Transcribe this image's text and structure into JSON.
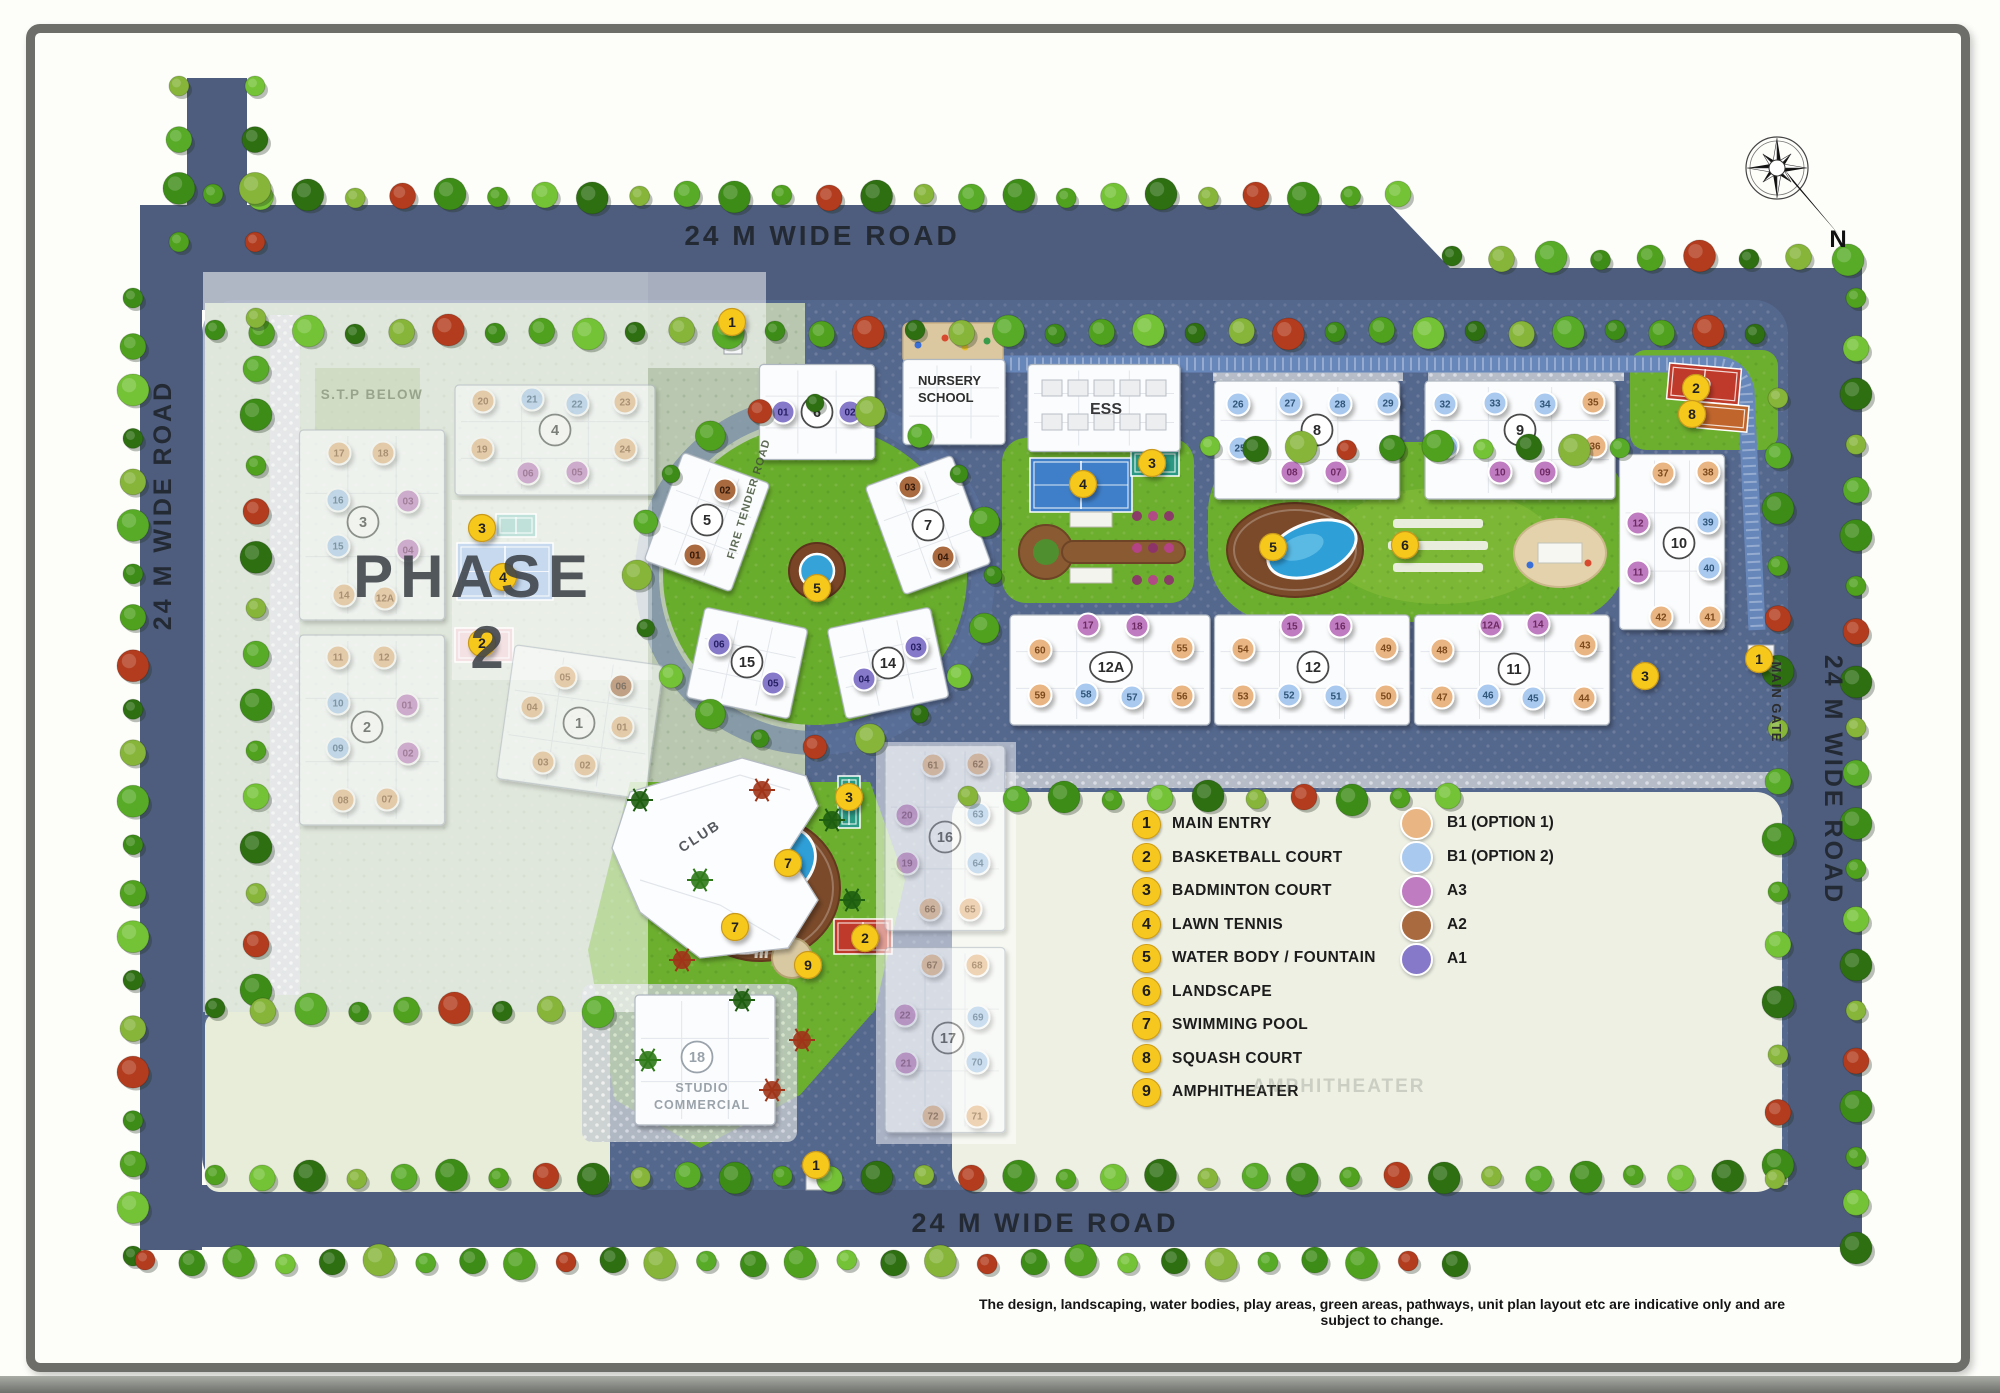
{
  "labels": {
    "road_top": "24 M WIDE ROAD",
    "road_bottom": "24 M WIDE ROAD",
    "road_left": "24 M WIDE ROAD",
    "road_right": "24 M WIDE ROAD",
    "main_gate": "MAIN GATE",
    "fire_tender": "FIRE TENDER ROAD",
    "stp": "S.T.P BELOW",
    "phase_line1": "PHASE",
    "phase_line2": "2",
    "compass_n": "N"
  },
  "special": {
    "nursery_line1": "NURSERY",
    "nursery_line2": "SCHOOL",
    "ess": "ESS",
    "club": "CLUB",
    "studio_line1": "STUDIO",
    "studio_line2": "COMMERCIAL"
  },
  "disclaimer": "The design, landscaping, water bodies, play areas, green areas, pathways, unit plan layout etc are indicative only and are subject to change.",
  "legend": {
    "items": [
      {
        "num": "1",
        "label": "MAIN ENTRY"
      },
      {
        "num": "2",
        "label": "BASKETBALL COURT"
      },
      {
        "num": "3",
        "label": "BADMINTON COURT"
      },
      {
        "num": "4",
        "label": "LAWN TENNIS"
      },
      {
        "num": "5",
        "label": "WATER BODY / FOUNTAIN"
      },
      {
        "num": "6",
        "label": "LANDSCAPE"
      },
      {
        "num": "7",
        "label": "SWIMMING POOL"
      },
      {
        "num": "8",
        "label": "SQUASH COURT"
      },
      {
        "num": "9",
        "label": "AMPHITHEATER"
      }
    ],
    "unit_types": [
      {
        "code": "t1",
        "label": "B1 (OPTION 1)",
        "color": "#e8b583"
      },
      {
        "code": "t2",
        "label": "B1 (OPTION 2)",
        "color": "#a9c9ef"
      },
      {
        "code": "a3",
        "label": "A3",
        "color": "#bf7cc0"
      },
      {
        "code": "a2",
        "label": "A2",
        "color": "#a96a3f"
      },
      {
        "code": "a1",
        "label": "A1",
        "color": "#8779c9"
      }
    ],
    "watermark": "AMPHITHEATER"
  },
  "unit_text_colors": {
    "t1": "#7c4a1d",
    "t2": "#2f5578",
    "a3": "#6d2a62",
    "a2": "#33190a",
    "a1": "#241e63"
  },
  "markers": [
    {
      "n": "1",
      "x": 732,
      "y": 322
    },
    {
      "n": "3",
      "x": 482,
      "y": 528
    },
    {
      "n": "4",
      "x": 503,
      "y": 577
    },
    {
      "n": "2",
      "x": 482,
      "y": 643
    },
    {
      "n": "4",
      "x": 1083,
      "y": 484
    },
    {
      "n": "3",
      "x": 1152,
      "y": 463
    },
    {
      "n": "5",
      "x": 817,
      "y": 588
    },
    {
      "n": "5",
      "x": 1273,
      "y": 547
    },
    {
      "n": "6",
      "x": 1405,
      "y": 545
    },
    {
      "n": "2",
      "x": 1696,
      "y": 388
    },
    {
      "n": "8",
      "x": 1692,
      "y": 414
    },
    {
      "n": "3",
      "x": 1645,
      "y": 676
    },
    {
      "n": "1",
      "x": 1759,
      "y": 659
    },
    {
      "n": "3",
      "x": 849,
      "y": 797
    },
    {
      "n": "7",
      "x": 788,
      "y": 863
    },
    {
      "n": "7",
      "x": 735,
      "y": 927
    },
    {
      "n": "2",
      "x": 865,
      "y": 938
    },
    {
      "n": "9",
      "x": 808,
      "y": 965
    },
    {
      "n": "1",
      "x": 816,
      "y": 1165
    }
  ],
  "gates": [
    {
      "x": 724,
      "y": 330,
      "w": 18,
      "h": 24
    },
    {
      "x": 1748,
      "y": 645,
      "w": 26,
      "h": 18
    },
    {
      "x": 806,
      "y": 1168,
      "w": 18,
      "h": 22
    }
  ],
  "buildings": [
    {
      "num": "4",
      "cx": 555,
      "cy": 440,
      "w": 200,
      "h": 110,
      "nx": 555,
      "ny": 430,
      "faded": true,
      "units": [
        [
          "20",
          "t1",
          483,
          401
        ],
        [
          "21",
          "t2",
          532,
          399
        ],
        [
          "22",
          "t2",
          577,
          404
        ],
        [
          "23",
          "t1",
          625,
          402
        ],
        [
          "19",
          "t1",
          482,
          449
        ],
        [
          "24",
          "t1",
          625,
          449
        ],
        [
          "06",
          "a3",
          528,
          473
        ],
        [
          "05",
          "a3",
          577,
          472
        ]
      ]
    },
    {
      "num": "3",
      "cx": 372,
      "cy": 525,
      "w": 145,
      "h": 190,
      "nx": 363,
      "ny": 522,
      "faded": true,
      "units": [
        [
          "17",
          "t1",
          339,
          453
        ],
        [
          "18",
          "t1",
          383,
          453
        ],
        [
          "16",
          "t2",
          338,
          500
        ],
        [
          "03",
          "a3",
          408,
          501
        ],
        [
          "15",
          "t2",
          338,
          546
        ],
        [
          "04",
          "a3",
          408,
          550
        ],
        [
          "14",
          "t1",
          344,
          595
        ],
        [
          "12A",
          "t1",
          385,
          598
        ]
      ]
    },
    {
      "num": "2",
      "cx": 372,
      "cy": 730,
      "w": 145,
      "h": 190,
      "nx": 367,
      "ny": 727,
      "faded": true,
      "units": [
        [
          "11",
          "t1",
          338,
          657
        ],
        [
          "12",
          "t1",
          384,
          657
        ],
        [
          "10",
          "t2",
          338,
          703
        ],
        [
          "01",
          "a3",
          407,
          705
        ],
        [
          "09",
          "t2",
          338,
          748
        ],
        [
          "02",
          "a3",
          408,
          753
        ],
        [
          "08",
          "t1",
          343,
          800
        ],
        [
          "07",
          "t1",
          387,
          799
        ]
      ]
    },
    {
      "num": "1",
      "cx": 580,
      "cy": 722,
      "w": 150,
      "h": 135,
      "nx": 579,
      "ny": 723,
      "rot": 8,
      "faded": true,
      "units": [
        [
          "05",
          "t1",
          565,
          677
        ],
        [
          "06",
          "a2",
          621,
          686
        ],
        [
          "04",
          "t1",
          532,
          707
        ],
        [
          "01",
          "t1",
          622,
          727
        ],
        [
          "03",
          "t1",
          543,
          762
        ],
        [
          "02",
          "t1",
          585,
          765
        ]
      ]
    },
    {
      "num": "6",
      "cx": 817,
      "cy": 412,
      "w": 115,
      "h": 95,
      "nx": 817,
      "ny": 412,
      "units": [
        [
          "01",
          "a1",
          783,
          412
        ],
        [
          "02",
          "a1",
          850,
          412
        ]
      ]
    },
    {
      "num": "5",
      "cx": 707,
      "cy": 522,
      "w": 92,
      "h": 115,
      "nx": 707,
      "ny": 520,
      "rot": 20,
      "units": [
        [
          "02",
          "a2",
          725,
          490
        ],
        [
          "01",
          "a2",
          695,
          555
        ]
      ]
    },
    {
      "num": "7",
      "cx": 928,
      "cy": 525,
      "w": 92,
      "h": 115,
      "nx": 928,
      "ny": 525,
      "rot": -20,
      "units": [
        [
          "03",
          "a2",
          910,
          487
        ],
        [
          "04",
          "a2",
          943,
          557
        ]
      ]
    },
    {
      "num": "15",
      "cx": 747,
      "cy": 663,
      "w": 105,
      "h": 92,
      "nx": 747,
      "ny": 662,
      "rot": 12,
      "units": [
        [
          "06",
          "a1",
          719,
          644
        ],
        [
          "05",
          "a1",
          773,
          683
        ]
      ]
    },
    {
      "num": "14",
      "cx": 888,
      "cy": 663,
      "w": 105,
      "h": 92,
      "nx": 888,
      "ny": 663,
      "rot": -12,
      "units": [
        [
          "03",
          "a1",
          916,
          647
        ],
        [
          "04",
          "a1",
          864,
          679
        ]
      ]
    },
    {
      "num": "8",
      "cx": 1307,
      "cy": 440,
      "w": 185,
      "h": 118,
      "nx": 1317,
      "ny": 430,
      "units": [
        [
          "26",
          "t2",
          1238,
          404
        ],
        [
          "27",
          "t2",
          1290,
          403
        ],
        [
          "28",
          "t2",
          1340,
          404
        ],
        [
          "29",
          "t2",
          1388,
          403
        ],
        [
          "25",
          "t2",
          1240,
          448
        ],
        [
          "30",
          "t2",
          1390,
          446
        ],
        [
          "08",
          "a3",
          1292,
          472
        ],
        [
          "07",
          "a3",
          1336,
          472
        ]
      ]
    },
    {
      "num": "9",
      "cx": 1520,
      "cy": 440,
      "w": 190,
      "h": 118,
      "nx": 1520,
      "ny": 430,
      "units": [
        [
          "32",
          "t2",
          1445,
          404
        ],
        [
          "33",
          "t2",
          1495,
          403
        ],
        [
          "34",
          "t2",
          1545,
          404
        ],
        [
          "35",
          "t1",
          1593,
          402
        ],
        [
          "31",
          "t2",
          1447,
          446
        ],
        [
          "36",
          "t1",
          1595,
          446
        ],
        [
          "10",
          "a3",
          1500,
          472
        ],
        [
          "09",
          "a3",
          1545,
          472
        ]
      ]
    },
    {
      "num": "10",
      "cx": 1672,
      "cy": 542,
      "w": 105,
      "h": 175,
      "nx": 1679,
      "ny": 543,
      "units": [
        [
          "37",
          "t1",
          1663,
          473
        ],
        [
          "38",
          "t1",
          1708,
          472
        ],
        [
          "12",
          "a3",
          1638,
          523
        ],
        [
          "39",
          "t2",
          1708,
          522
        ],
        [
          "11",
          "a3",
          1638,
          572
        ],
        [
          "40",
          "t2",
          1709,
          568
        ],
        [
          "42",
          "t1",
          1661,
          617
        ],
        [
          "41",
          "t1",
          1710,
          617
        ]
      ]
    },
    {
      "num": "12A",
      "cx": 1110,
      "cy": 670,
      "w": 200,
      "h": 110,
      "nx": 1111,
      "ny": 667,
      "units": [
        [
          "17",
          "a3",
          1088,
          625
        ],
        [
          "18",
          "a3",
          1137,
          626
        ],
        [
          "60",
          "t1",
          1040,
          650
        ],
        [
          "55",
          "t1",
          1182,
          648
        ],
        [
          "59",
          "t1",
          1040,
          695
        ],
        [
          "58",
          "t2",
          1086,
          694
        ],
        [
          "57",
          "t2",
          1132,
          697
        ],
        [
          "56",
          "t1",
          1182,
          696
        ]
      ]
    },
    {
      "num": "12",
      "cx": 1312,
      "cy": 670,
      "w": 195,
      "h": 110,
      "nx": 1313,
      "ny": 667,
      "units": [
        [
          "15",
          "a3",
          1292,
          626
        ],
        [
          "16",
          "a3",
          1340,
          626
        ],
        [
          "54",
          "t1",
          1243,
          649
        ],
        [
          "49",
          "t1",
          1386,
          648
        ],
        [
          "53",
          "t1",
          1243,
          696
        ],
        [
          "52",
          "t2",
          1289,
          695
        ],
        [
          "51",
          "t2",
          1336,
          696
        ],
        [
          "50",
          "t1",
          1386,
          696
        ]
      ]
    },
    {
      "num": "11",
      "cx": 1512,
      "cy": 670,
      "w": 195,
      "h": 110,
      "nx": 1514,
      "ny": 669,
      "units": [
        [
          "12A",
          "a3",
          1491,
          625
        ],
        [
          "14",
          "a3",
          1538,
          624
        ],
        [
          "48",
          "t1",
          1442,
          650
        ],
        [
          "43",
          "t1",
          1585,
          645
        ],
        [
          "47",
          "t1",
          1442,
          697
        ],
        [
          "46",
          "t2",
          1488,
          695
        ],
        [
          "45",
          "t2",
          1533,
          698
        ],
        [
          "44",
          "t1",
          1584,
          698
        ]
      ]
    },
    {
      "num": "16",
      "cx": 945,
      "cy": 838,
      "w": 120,
      "h": 185,
      "nx": 945,
      "ny": 837,
      "faded": true,
      "units": [
        [
          "61",
          "t1",
          933,
          765
        ],
        [
          "62",
          "t1",
          978,
          764
        ],
        [
          "20",
          "a3",
          907,
          815
        ],
        [
          "63",
          "t2",
          978,
          814
        ],
        [
          "19",
          "a3",
          907,
          863
        ],
        [
          "64",
          "t2",
          978,
          863
        ],
        [
          "66",
          "t1",
          930,
          909
        ],
        [
          "65",
          "t1",
          970,
          909
        ]
      ]
    },
    {
      "num": "17",
      "cx": 945,
      "cy": 1040,
      "w": 120,
      "h": 185,
      "nx": 948,
      "ny": 1038,
      "faded": true,
      "units": [
        [
          "67",
          "t1",
          932,
          965
        ],
        [
          "68",
          "t1",
          977,
          965
        ],
        [
          "22",
          "a3",
          905,
          1015
        ],
        [
          "69",
          "t2",
          978,
          1017
        ],
        [
          "21",
          "a3",
          906,
          1063
        ],
        [
          "70",
          "t2",
          977,
          1062
        ],
        [
          "72",
          "t1",
          933,
          1116
        ],
        [
          "71",
          "t1",
          977,
          1116
        ]
      ]
    },
    {
      "num": "18",
      "cx": 705,
      "cy": 1060,
      "w": 140,
      "h": 130,
      "nx": 697,
      "ny": 1057,
      "gray": true,
      "units": []
    },
    {
      "num": "",
      "name": "nursery",
      "cx": 954,
      "cy": 402,
      "w": 102,
      "h": 85,
      "units": []
    },
    {
      "num": "",
      "name": "ess",
      "cx": 1104,
      "cy": 408,
      "w": 152,
      "h": 87,
      "grid": true,
      "units": []
    }
  ],
  "amenities": [
    {
      "kind": "tennis",
      "x": 457,
      "y": 543,
      "w": 96,
      "h": 57,
      "p2": true
    },
    {
      "kind": "badminton",
      "x": 496,
      "y": 514,
      "w": 40,
      "h": 23,
      "p2": true
    },
    {
      "kind": "basketball_pink",
      "x": 455,
      "y": 628,
      "w": 58,
      "h": 34,
      "p2": true
    },
    {
      "kind": "tennis",
      "x": 1030,
      "y": 458,
      "w": 102,
      "h": 54
    },
    {
      "kind": "badminton",
      "x": 1131,
      "y": 450,
      "w": 48,
      "h": 26
    },
    {
      "kind": "basketball",
      "x": 1668,
      "y": 366,
      "w": 72,
      "h": 36,
      "rot": 5
    },
    {
      "kind": "squash",
      "x": 1698,
      "y": 404,
      "w": 50,
      "h": 26,
      "rot": 5
    },
    {
      "kind": "badminton_v",
      "x": 838,
      "y": 776,
      "w": 22,
      "h": 52
    },
    {
      "kind": "basketball",
      "x": 834,
      "y": 919,
      "w": 58,
      "h": 35
    },
    {
      "kind": "fountain",
      "cx": 817,
      "cy": 571
    },
    {
      "kind": "pool_deck",
      "cx": 1295,
      "cy": 550,
      "rx": 68,
      "ry": 47
    },
    {
      "kind": "pool",
      "cx": 1312,
      "cy": 549,
      "rx": 46,
      "ry": 26,
      "rot": -10
    },
    {
      "kind": "pool_deck",
      "cx": 760,
      "cy": 888,
      "rx": 80,
      "ry": 73
    },
    {
      "kind": "pool",
      "cx": 776,
      "cy": 862,
      "rx": 41,
      "ry": 34,
      "rot": -15
    },
    {
      "kind": "pool",
      "cx": 737,
      "cy": 923,
      "rx": 41,
      "ry": 29,
      "rot": 8
    },
    {
      "kind": "pool",
      "cx": 708,
      "cy": 869,
      "rx": 23,
      "ry": 19,
      "rot": 0
    },
    {
      "kind": "amphitheater",
      "cx": 792,
      "cy": 958
    },
    {
      "kind": "playground",
      "x": 903,
      "y": 323,
      "w": 100,
      "h": 40
    },
    {
      "kind": "playground_e",
      "cx": 1560,
      "cy": 553,
      "rx": 46,
      "ry": 34
    },
    {
      "kind": "garden",
      "cx": 1095,
      "cy": 550
    },
    {
      "kind": "parcourse",
      "cx": 1438,
      "cy": 545
    }
  ]
}
